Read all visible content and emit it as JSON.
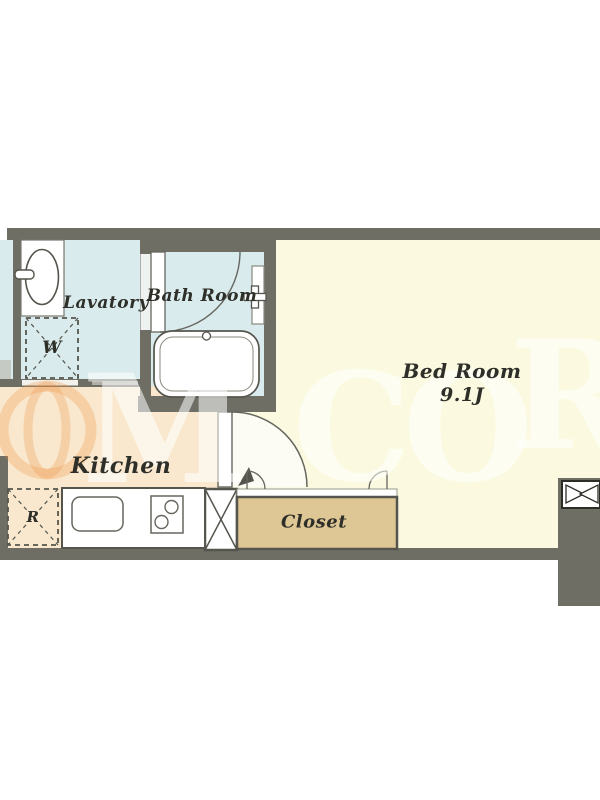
{
  "floorplan": {
    "rooms": {
      "lavatory": {
        "label": "Lavatory"
      },
      "bath": {
        "label": "Bath Room"
      },
      "bedroom": {
        "label": "Bed Room",
        "size": "9.1J"
      },
      "kitchen": {
        "label": "Kitchen"
      },
      "closet": {
        "label": "Closet"
      }
    },
    "fixtures": {
      "washing_machine_mark": "W",
      "refrigerator_mark": "R"
    },
    "watermark": {
      "letters": [
        "M",
        "C",
        "O",
        "R"
      ]
    },
    "colors": {
      "wall": "#6e6e65",
      "wet_area_floor": "#d9ebec",
      "kitchen_floor": "#f9e8ce",
      "bedroom_floor": "#fbfae0",
      "closet_fill": "#dfc795",
      "outline": "#55554d",
      "watermark_orange": "#ed9446"
    }
  }
}
